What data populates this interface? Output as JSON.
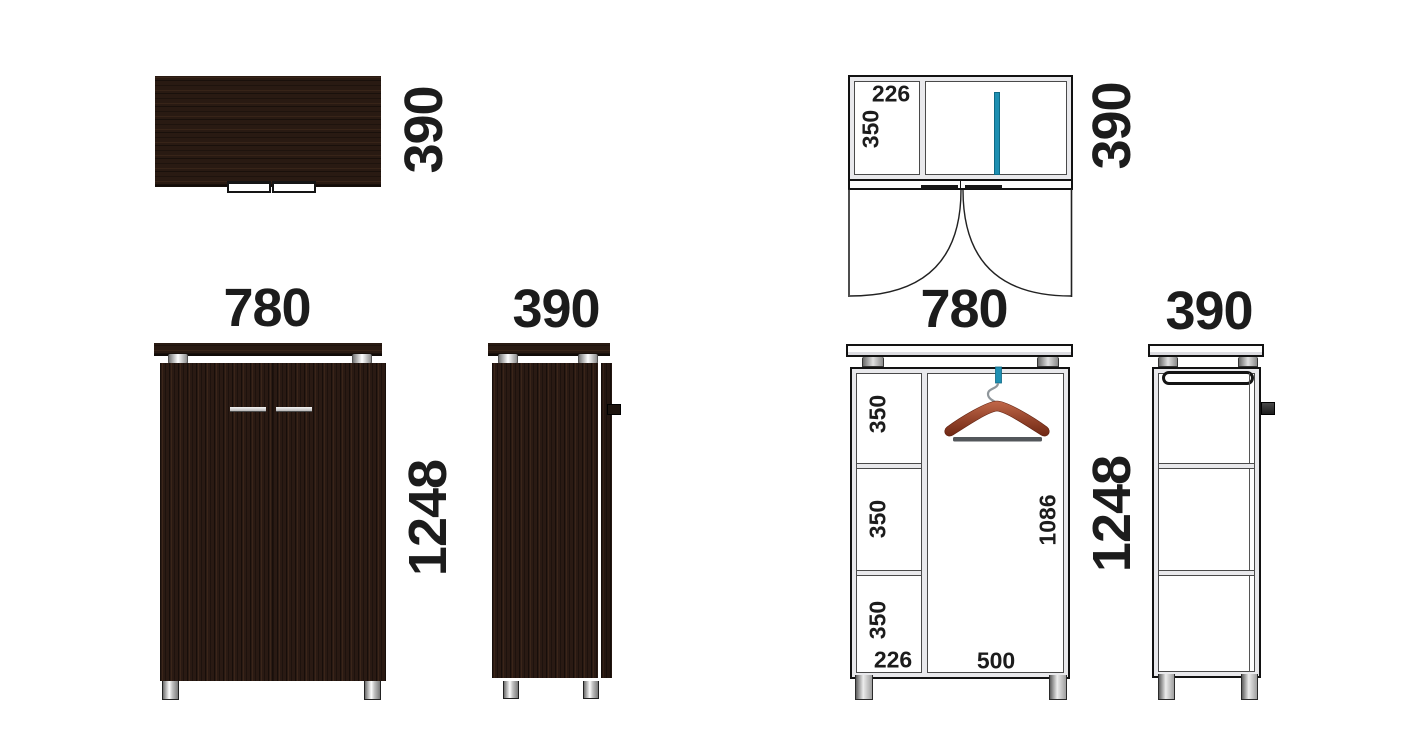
{
  "views": {
    "wood_top": {
      "depth": "390"
    },
    "wood_front": {
      "width": "780",
      "height": "1248"
    },
    "wood_side": {
      "depth": "390"
    },
    "schematic_top": {
      "compartment_width": "226",
      "compartment_depth": "350",
      "depth": "390",
      "width": "780"
    },
    "schematic_front": {
      "shelves": [
        "350",
        "350",
        "350"
      ],
      "compartment_width": "226",
      "hanging_width": "500",
      "hanging_height": "1086",
      "height": "1248"
    },
    "schematic_side": {
      "depth": "390"
    }
  },
  "colors": {
    "wood": "#2a1a13",
    "rod_teal": "#1e8fb2",
    "hanger_wood": "#a84a2e",
    "metal": "#c9c9c9",
    "line": "#121212"
  }
}
